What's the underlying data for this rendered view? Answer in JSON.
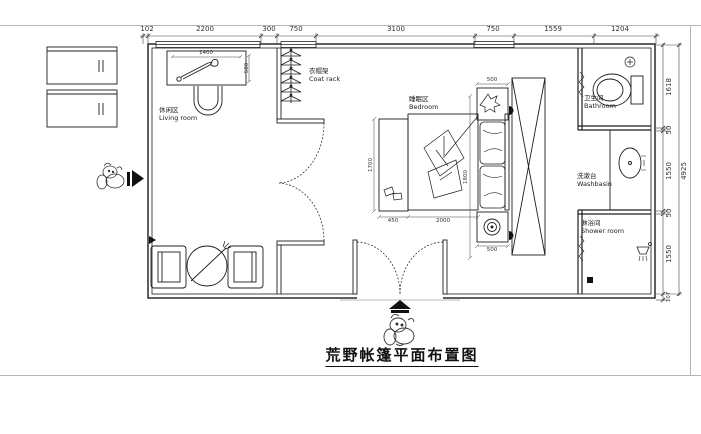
{
  "title": "荒野帐篷平面布置图",
  "rooms": {
    "living": {
      "zh": "休闲区",
      "en": "Living room"
    },
    "coat_rack": {
      "zh": "衣帽架",
      "en": "Coat rack"
    },
    "bedroom": {
      "zh": "睡眠区",
      "en": "Bedroom"
    },
    "bathroom": {
      "zh": "卫生间",
      "en": "Bathroom"
    },
    "washbasin": {
      "zh": "洗漱台",
      "en": "Washbasin"
    },
    "shower": {
      "zh": "淋浴间",
      "en": "Shower room"
    }
  },
  "dims": {
    "top": [
      "102",
      "2200",
      "300",
      "750",
      "3100",
      "750",
      "1559",
      "1204"
    ],
    "right": [
      "1618",
      "50",
      "1550",
      "50",
      "1550",
      "107"
    ],
    "right_total": "4925",
    "desk_width": "1400",
    "desk_depth": "500",
    "bench_width": "450",
    "bed_width": "2000",
    "bench_length": "1700",
    "bed_length": "1800",
    "nightstand_top": "500",
    "nightstand_bottom": "500"
  },
  "colors": {
    "line": "#1d1d1d",
    "dim_line": "#444444",
    "page_border": "#b5b5b5"
  }
}
